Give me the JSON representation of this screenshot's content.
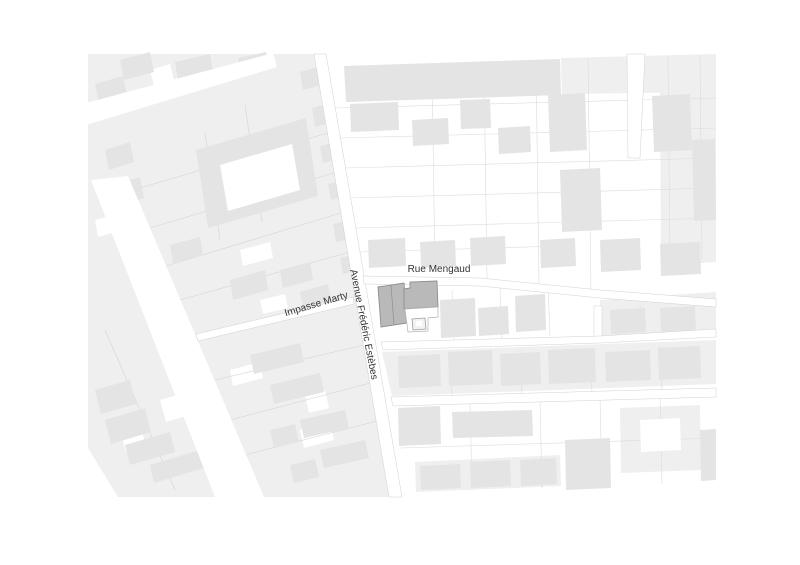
{
  "map": {
    "type": "site-plan",
    "labels": {
      "rue_mengaud": "Rue Mengaud",
      "avenue": "Avenue Frédéric Estèbes",
      "impasse_marty": "Impasse Marty"
    },
    "colors": {
      "background": "#ffffff",
      "block_fill": "#efefef",
      "building_fill": "#e4e4e4",
      "parcel_line": "#dcdcdc",
      "street_outline": "#d0d0d0",
      "site_fill": "#b9b9b9",
      "site_outline": "#8f8f8f",
      "label_text": "#333333"
    }
  }
}
